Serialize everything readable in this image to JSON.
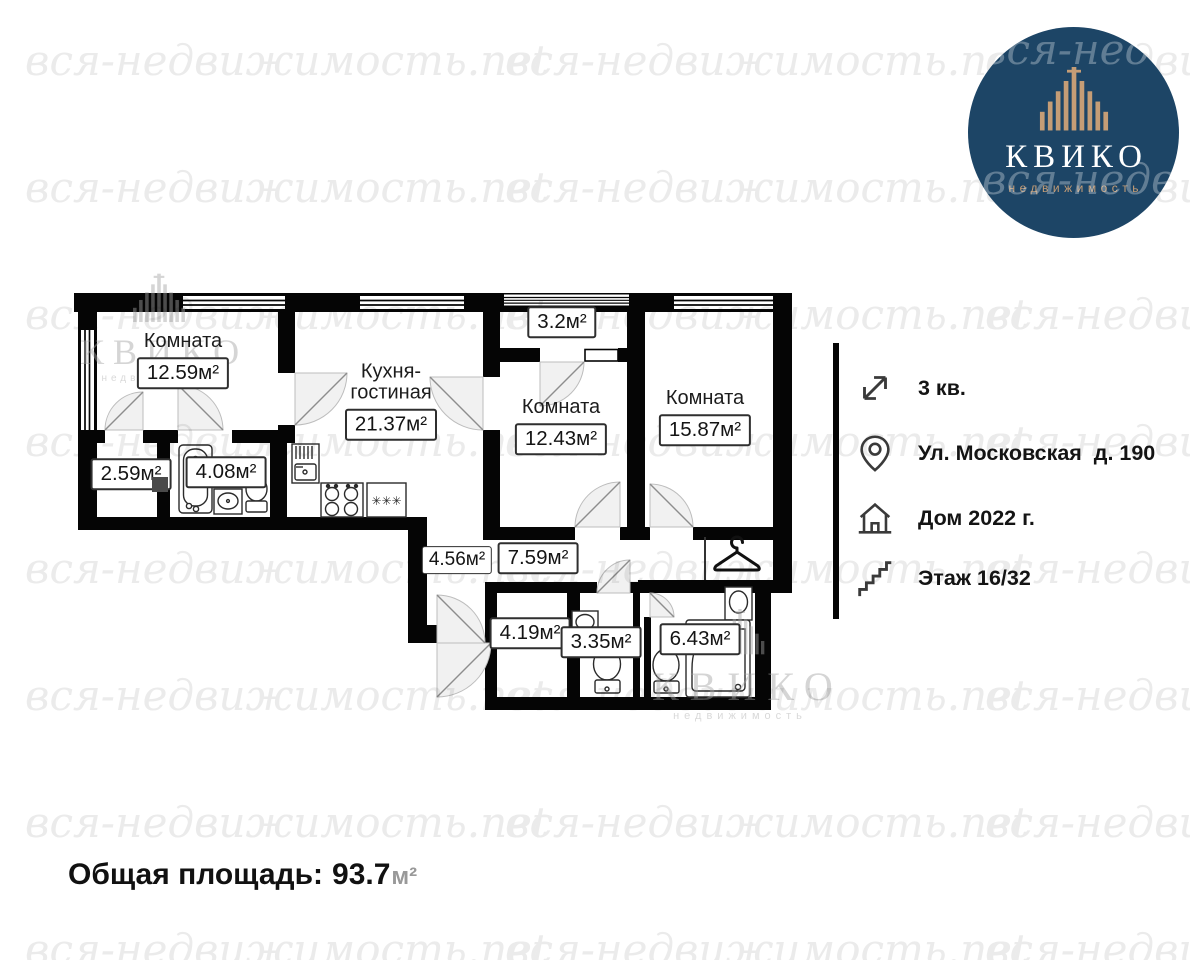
{
  "watermark": {
    "text": "вся-недвижимость.net"
  },
  "logo": {
    "title": "КВИКО",
    "subtitle": "недвижимость",
    "navy": "#1d4566",
    "gold": "#c59d76"
  },
  "info": {
    "items": [
      {
        "icon": "area-expand-icon",
        "label": "3 кв."
      },
      {
        "icon": "location-pin-icon",
        "label": "Ул. Московская  д. 190"
      },
      {
        "icon": "house-icon",
        "label": "Дом 2022 г."
      },
      {
        "icon": "stairs-icon",
        "label": "Этаж 16/32"
      }
    ]
  },
  "plan": {
    "rooms": [
      {
        "name": "Комната",
        "area": "12.59м²"
      },
      {
        "name": "Кухня-гостиная",
        "area": "21.37м²"
      },
      {
        "name": "",
        "area": "3.2м²"
      },
      {
        "name": "Комната",
        "area": "12.43м²"
      },
      {
        "name": "Комната",
        "area": "15.87м²"
      },
      {
        "name": "",
        "area": "2.59м²"
      },
      {
        "name": "",
        "area": "4.08м²"
      },
      {
        "name": "",
        "area": "4.56м²"
      },
      {
        "name": "",
        "area": "7.59м²"
      },
      {
        "name": "",
        "area": "4.19м²"
      },
      {
        "name": "",
        "area": "3.35м²"
      },
      {
        "name": "",
        "area": "6.43м²"
      }
    ],
    "freezer_symbol": "✳✳✳"
  },
  "total": {
    "label": "Общая площадь:",
    "value": "93.7",
    "unit": "м²"
  }
}
